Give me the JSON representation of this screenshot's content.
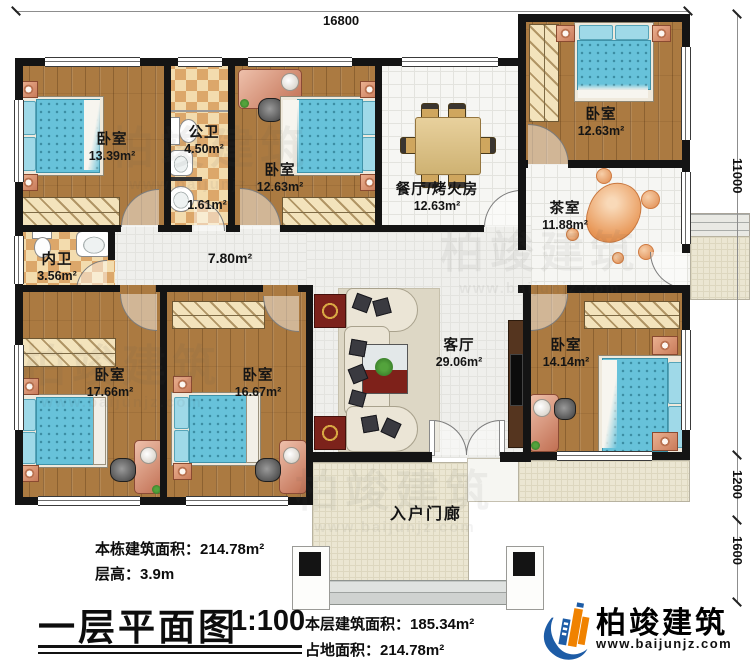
{
  "plan": {
    "dimensions": {
      "top": "16800",
      "right_upper": "11000",
      "right_mid": "1200",
      "right_lower": "1600"
    },
    "rooms": [
      {
        "name": "卧室",
        "area": "13.39m²"
      },
      {
        "name": "公卫",
        "area": "4.50m²"
      },
      {
        "name": "",
        "area": "1.61m²"
      },
      {
        "name": "卧室",
        "area": "12.63m²"
      },
      {
        "name": "餐厅/烤火房",
        "area": "12.63m²"
      },
      {
        "name": "卧室",
        "area": "12.63m²"
      },
      {
        "name": "茶室",
        "area": "11.88m²"
      },
      {
        "name": "内卫",
        "area": "3.56m²"
      },
      {
        "name": "",
        "area": "7.80m²"
      },
      {
        "name": "卧室",
        "area": "17.66m²"
      },
      {
        "name": "卧室",
        "area": "16.67m²"
      },
      {
        "name": "客厅",
        "area": "29.06m²"
      },
      {
        "name": "卧室",
        "area": "14.14m²"
      },
      {
        "name": "入户门廊",
        "area": ""
      }
    ]
  },
  "footer": {
    "building_total_label": "本栋建筑面积：",
    "building_total_value": "214.78m²",
    "floor_height_label": "层高：",
    "floor_height_value": "3.9m",
    "title": "一层平面图",
    "scale": "1:100",
    "floor_area_label": "本层建筑面积：",
    "floor_area_value": "185.34m²",
    "footprint_label": "占地面积：",
    "footprint_value": "214.78m²"
  },
  "brand": {
    "name": "柏竣建筑",
    "website": "www.baijunjz.com",
    "blue": "#1d5ca6",
    "orange": "#f08200"
  },
  "watermark": {
    "text": "柏竣建筑",
    "url": "www.baijunjz.com"
  }
}
